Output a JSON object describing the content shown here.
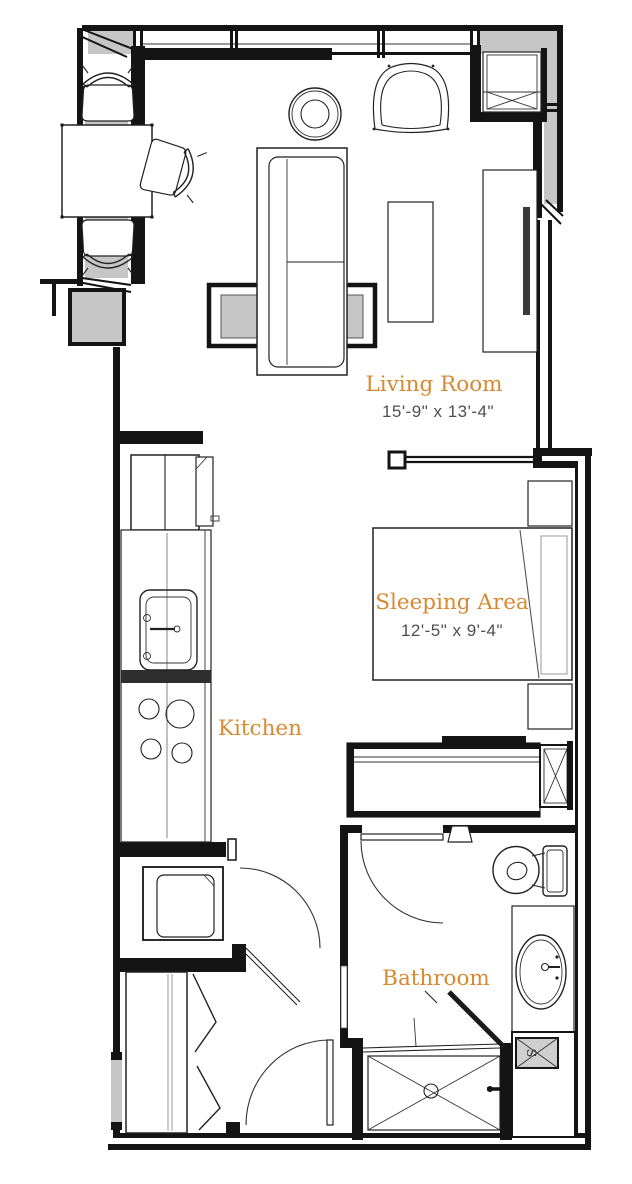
{
  "floor_plan": {
    "rooms": [
      {
        "id": "living-room",
        "name": "Living Room",
        "dimensions": "15'-9\" x 13'-4\""
      },
      {
        "id": "sleeping-area",
        "name": "Sleeping Area",
        "dimensions": "12'-5\" x 9'-4\""
      },
      {
        "id": "kitchen",
        "name": "Kitchen"
      },
      {
        "id": "bathroom",
        "name": "Bathroom"
      }
    ],
    "markers": {
      "shelf_label": "S"
    },
    "colors": {
      "room_label": "#d78932",
      "dimension_text": "#4f4f4f",
      "wall": "#141414",
      "window_panel": "#c6c6c6"
    },
    "fixtures": [
      "window-wall",
      "entry-closet",
      "dining-table",
      "dining-chair",
      "round-side-table",
      "lounge-chair",
      "sofa",
      "coffee-table",
      "media-console",
      "wall-tv",
      "structural-column",
      "half-wall-post",
      "refrigerator",
      "kitchen-counter",
      "kitchen-sink",
      "cooktop",
      "stacked-washer-dryer",
      "wardrobe",
      "bifold-closet-doors",
      "swing-door",
      "bed",
      "nightstand",
      "sliding-door-closet",
      "built-in-cabinet",
      "toilet",
      "vanity-sink",
      "shelf-cabinet",
      "walk-in-shower",
      "shower-door"
    ]
  }
}
